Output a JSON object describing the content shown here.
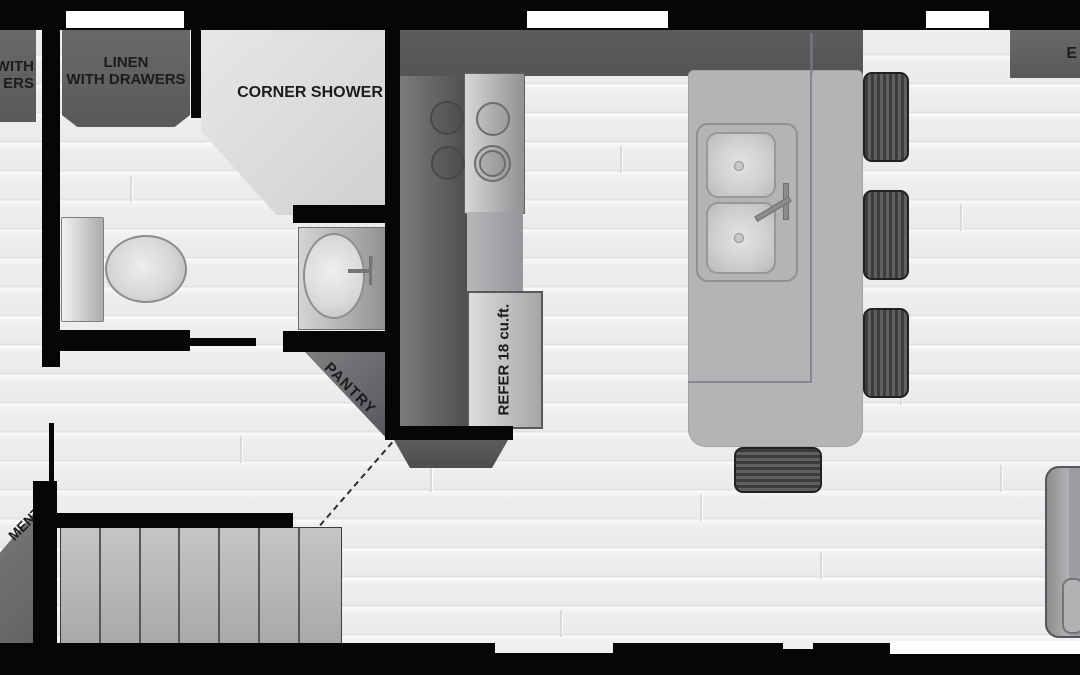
{
  "title": "tiny-home floor plan",
  "labels": {
    "left_cabinet_fragment": {
      "line1": "WITH",
      "line2": "ERS"
    },
    "linen_cabinet": {
      "line1": "LINEN",
      "line2": "WITH DRAWERS"
    },
    "corner_shower": "CORNER SHOWER",
    "pantry": "PANTRY",
    "refrigerator": "REFER 18 cu.ft.",
    "right_cabinet_fragment": "E",
    "entertainment_center_fragment": {
      "line1": "MENT",
      "line2": "ER"
    }
  },
  "colors": {
    "wall": "#060606",
    "cabinet_dark": "#5e6062",
    "counter_dark": "#58595b",
    "island_gray": "#b2b4b6",
    "appliance_light": "#cbccce",
    "floor": "#eff0f1",
    "window": "#ffffff",
    "label_text": "#1c1c1e"
  },
  "fixtures": [
    "linen cabinet with drawers",
    "corner shower",
    "toilet",
    "bathroom vanity sink",
    "pantry (corner)",
    "4-burner cooktop",
    "refrigerator 18 cu.ft.",
    "kitchen island with double sink",
    "4 bar stools",
    "bench / steps",
    "entertainment center",
    "sofa"
  ]
}
